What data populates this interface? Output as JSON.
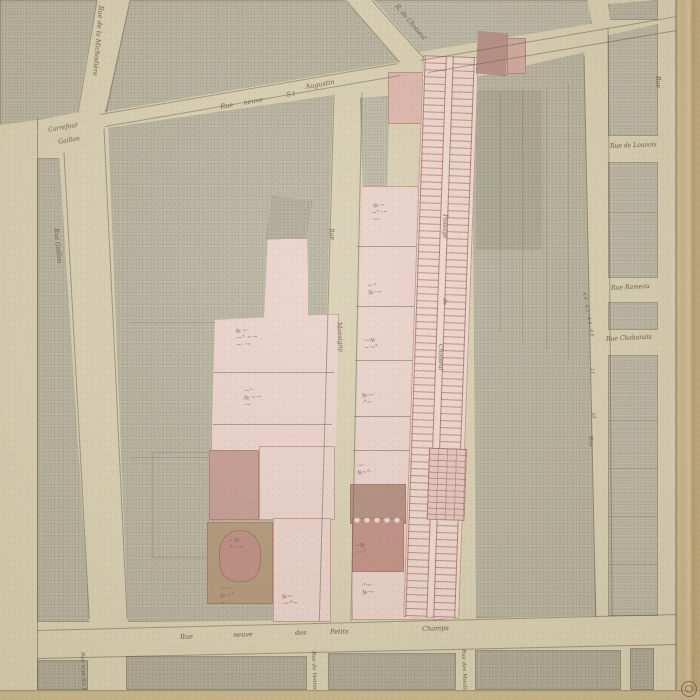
{
  "map": {
    "streets": {
      "michodiere": "Rue de la Michodière",
      "carrefour_line1": "Carrefour",
      "carrefour_line2": "Gaillon",
      "gaillon": "Rue Gaillon",
      "st_augustin": {
        "w1": "Rue",
        "w2": "neuve",
        "w3": "S.t",
        "w4": "Augustin"
      },
      "choiseul": "R. de Choiseul",
      "louvois": "Rue de Louvois",
      "rameau": "Rue Rameau",
      "chabanais": "Rue Chabanais",
      "monsigny_w1": "Rue",
      "monsigny_w2": "Monsigny",
      "passage_w1": "Passage",
      "passage_w2": "de",
      "passage_w3": "Choiseul",
      "petits_champs": {
        "w1": "Rue",
        "w2": "neuve",
        "w3": "des",
        "w4": "Petits",
        "w5": "Champs"
      },
      "st_roch": "Rue n.ve S.t Roch",
      "ventadour": "Rue de Ventadour",
      "moulins": "Rue des Moulins",
      "ste_anne": "Rue",
      "margin_right": "Rue"
    },
    "numbers": {
      "a": "40·42·44·46",
      "b": "11",
      "c": "33"
    },
    "annotations": {
      "plots": [
        {
          "text": "№ ~·\n·~° ~·~\n~· ·~"
        },
        {
          "text": "·~°·\n№ ~·~\n·~·"
        },
        {
          "text": "~·№·\n·°~·~"
        },
        {
          "text": "·~·~\n№·~°\n~··"
        },
        {
          "text": "№~·\n·~·°~"
        },
        {
          "text": "·№·~\n~°··~\n·~·"
        },
        {
          "text": "~·°\n№··~"
        },
        {
          "text": "·~№\n~·~°·"
        },
        {
          "text": "№·~·\n·°~·"
        },
        {
          "text": "·~·\n№~°·"
        },
        {
          "text": "~№·\n··~°"
        },
        {
          "text": "·°~·\n№·~"
        }
      ]
    },
    "colors": {
      "paper": "#d8cfb4",
      "block_stipple": "#b7b3a0",
      "plot_pink": "#e9d1ca",
      "building_rose": "#c39a92",
      "building_brown": "#b19678",
      "ink": "#5c5542"
    }
  }
}
